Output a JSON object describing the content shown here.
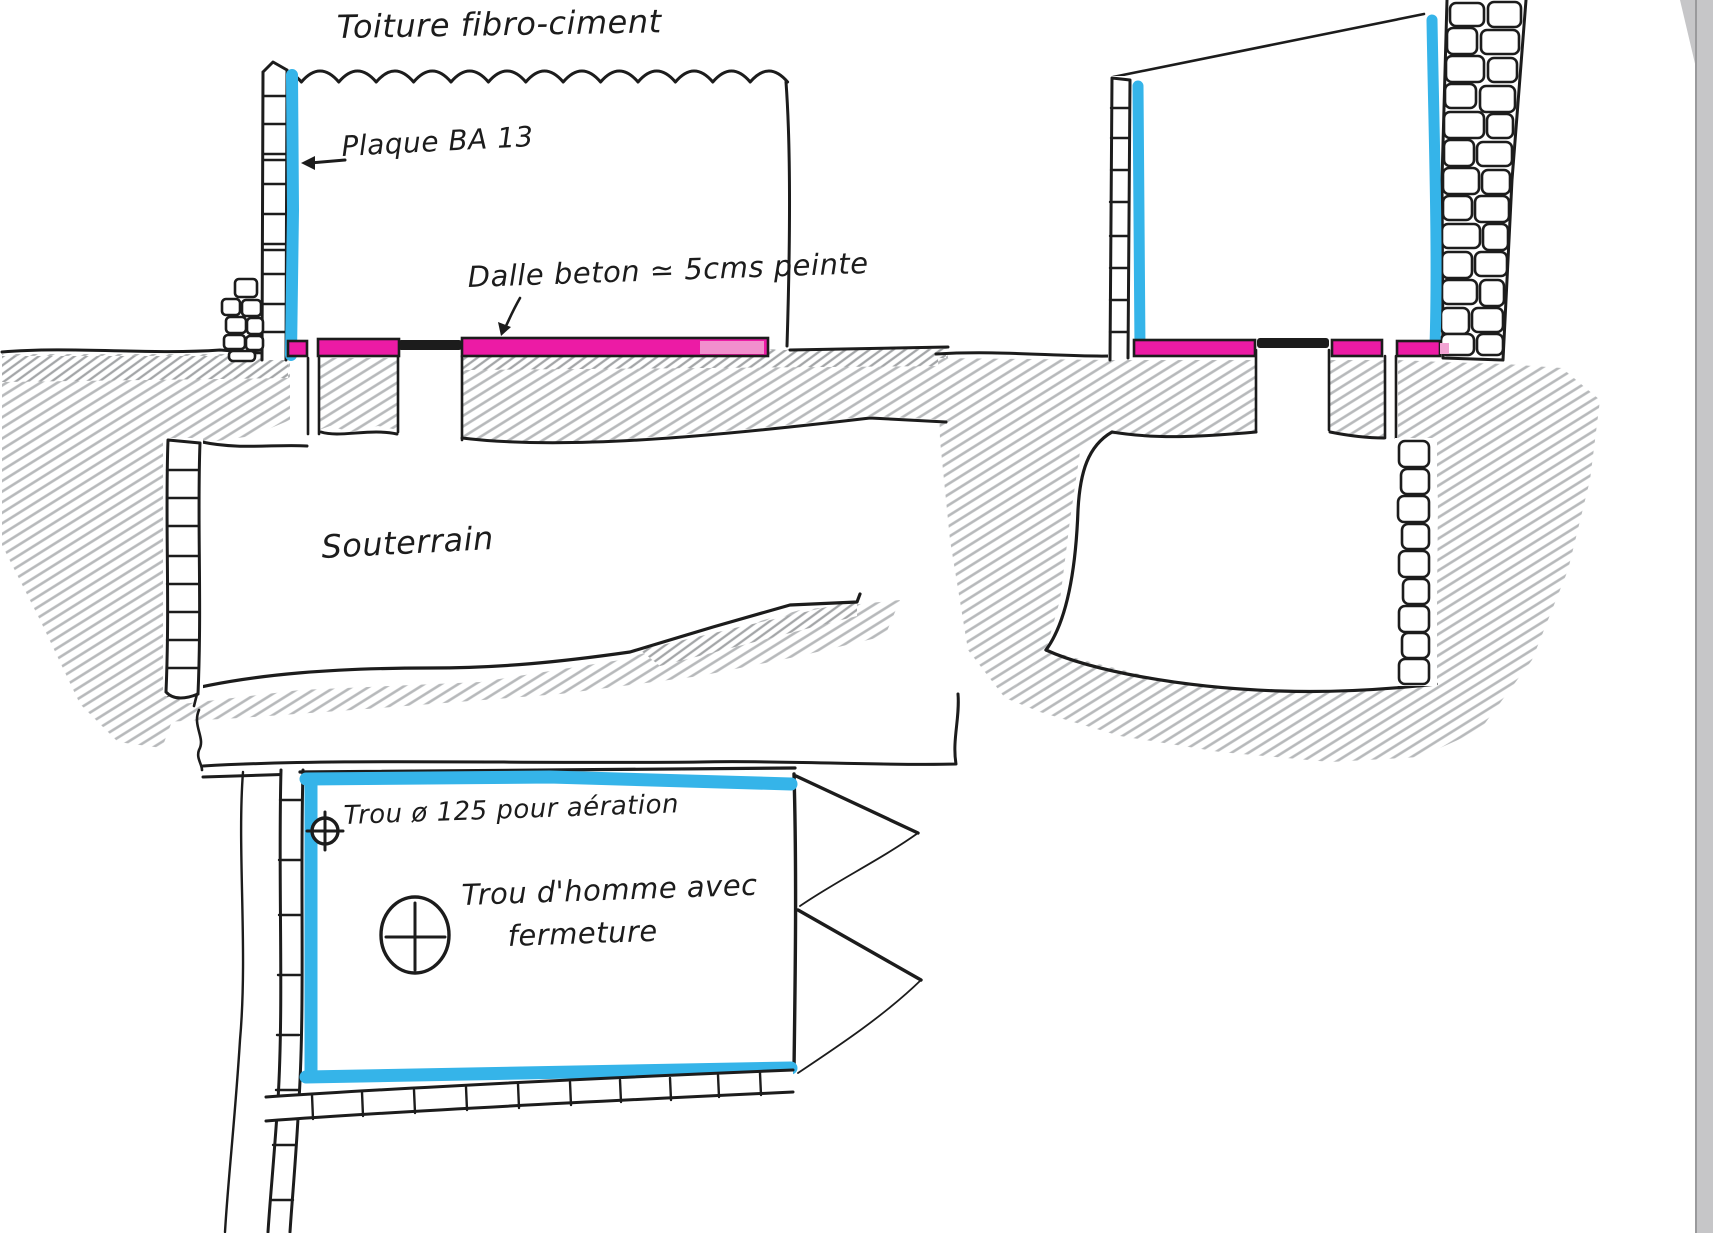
{
  "document": {
    "type": "hand-drawn construction sketch",
    "subject": "underground cistern / cellar sections and plan"
  },
  "colors": {
    "ink": "#1c1c1c",
    "marker_cyan": "#35b4e9",
    "marker_magenta": "#ec1ba5",
    "marker_pink_light": "#f2a3d3",
    "pencil_gray": "#b7b9bb",
    "pencil_gray_dark": "#a4a6a8",
    "paper": "#ffffff",
    "scan_edge": "#c6c6c8"
  },
  "left_section": {
    "roof_label": "Toiture fibro-ciment",
    "plasterboard_label": "Plaque BA 13",
    "slab_label": "Dalle beton ≃ 5cms peinte",
    "basement_label": "Souterrain"
  },
  "plan_view": {
    "vent_label": "Trou ø 125 pour aération",
    "manhole_label_line1": "Trou d'homme avec",
    "manhole_label_line2": "fermeture"
  }
}
